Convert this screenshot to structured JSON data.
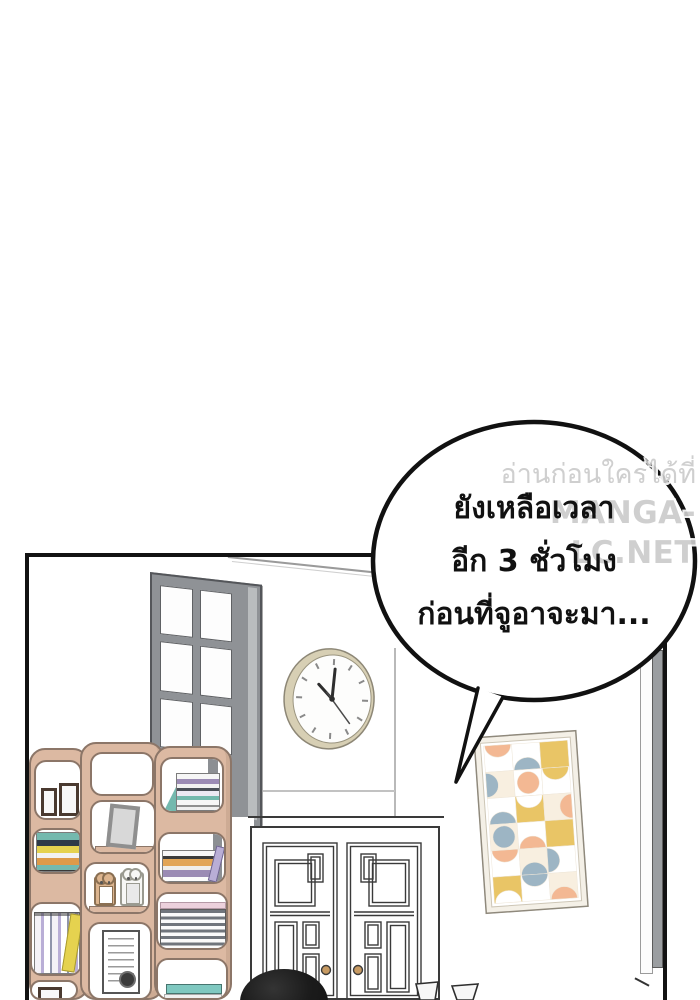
{
  "page": {
    "background": "#ffffff",
    "kind": "webtoon-comic-panel"
  },
  "speech_bubble": {
    "lines": [
      "ยังเหลือเวลา",
      "อีก 3 ชั่วโมง",
      "ก่อนที่จูอาจะมา..."
    ],
    "fill": "#ffffff",
    "stroke": "#111111"
  },
  "watermark": {
    "line1": "อ่านก่อนใครได้ที่",
    "line2": "MANGA-LC.NET",
    "color": "#cbcbcb"
  },
  "scene": {
    "wall_color": "#ffffff",
    "panel_border_color": "#121212",
    "glass_door": {
      "frame_color": "#8f9296",
      "pane_color": "#fdfdfd",
      "pane_cols": 2,
      "pane_rows": 4
    },
    "wall_clock": {
      "rim_color": "#d7cfb4",
      "face_color": "#fdfdfc",
      "approx_time": "10:01"
    },
    "bookshelf": {
      "wood_color": "#dcb9a2",
      "outline_color": "#8c7668",
      "contents": [
        "picture-frames",
        "horizontal-book-stacks",
        "leaning-gray-frame",
        "animal-photo-frames",
        "vertical-books",
        "magazine-stack",
        "certificate-with-seal",
        "teal-book"
      ]
    },
    "lattice_cabinet": {
      "body_color": "#ffffff",
      "line_color": "#3a3a3a",
      "knob_color": "#c79a62"
    },
    "art_frame": {
      "frame_color": "#f4f0e7",
      "palette": [
        "#9db5c4",
        "#f3b893",
        "#e9c566",
        "#f8efe0"
      ]
    },
    "figure": {
      "label": "person-head-silhouette",
      "hair_color": "#1a1a1a"
    },
    "cups_color": "#f7f7f7"
  }
}
